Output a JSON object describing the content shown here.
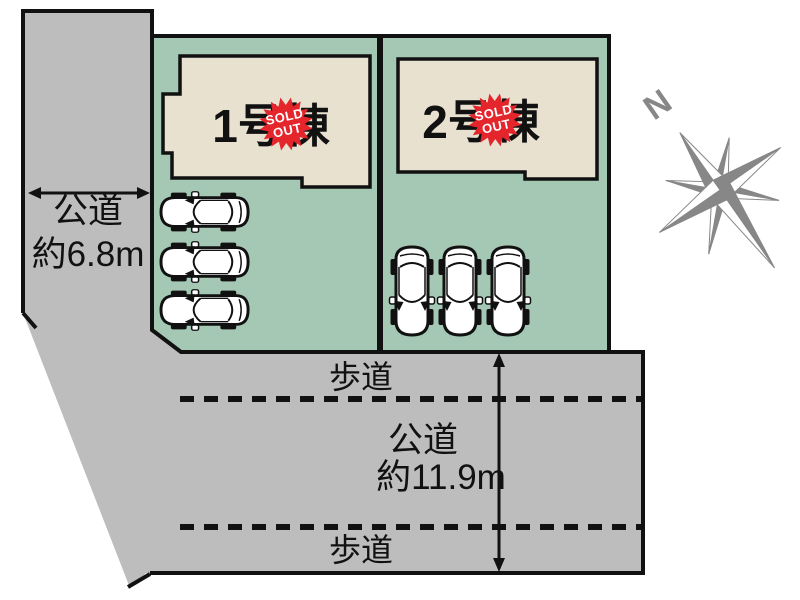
{
  "plan": {
    "left_road": {
      "line1": "公道",
      "line2": "約6.8m"
    },
    "bottom_road": {
      "sidewalk_top": "歩道",
      "sidewalk_bottom": "歩道",
      "line1": "公道",
      "line2": "約11.9m"
    },
    "lots": [
      {
        "building_label": "1号棟",
        "badge_line1": "SOLD",
        "badge_line2": "OUT",
        "cars": 3
      },
      {
        "building_label": "2号棟",
        "badge_line1": "SOLD",
        "badge_line2": "OUT",
        "cars": 3
      }
    ],
    "compass_north": "N"
  },
  "colors": {
    "road_gray": "#bdbdbd",
    "lot_green": "#a5c8b4",
    "building_beige": "#e9e1d0",
    "outline_black": "#111111",
    "badge_red": "#e5252c",
    "compass_gray": "#878787"
  }
}
